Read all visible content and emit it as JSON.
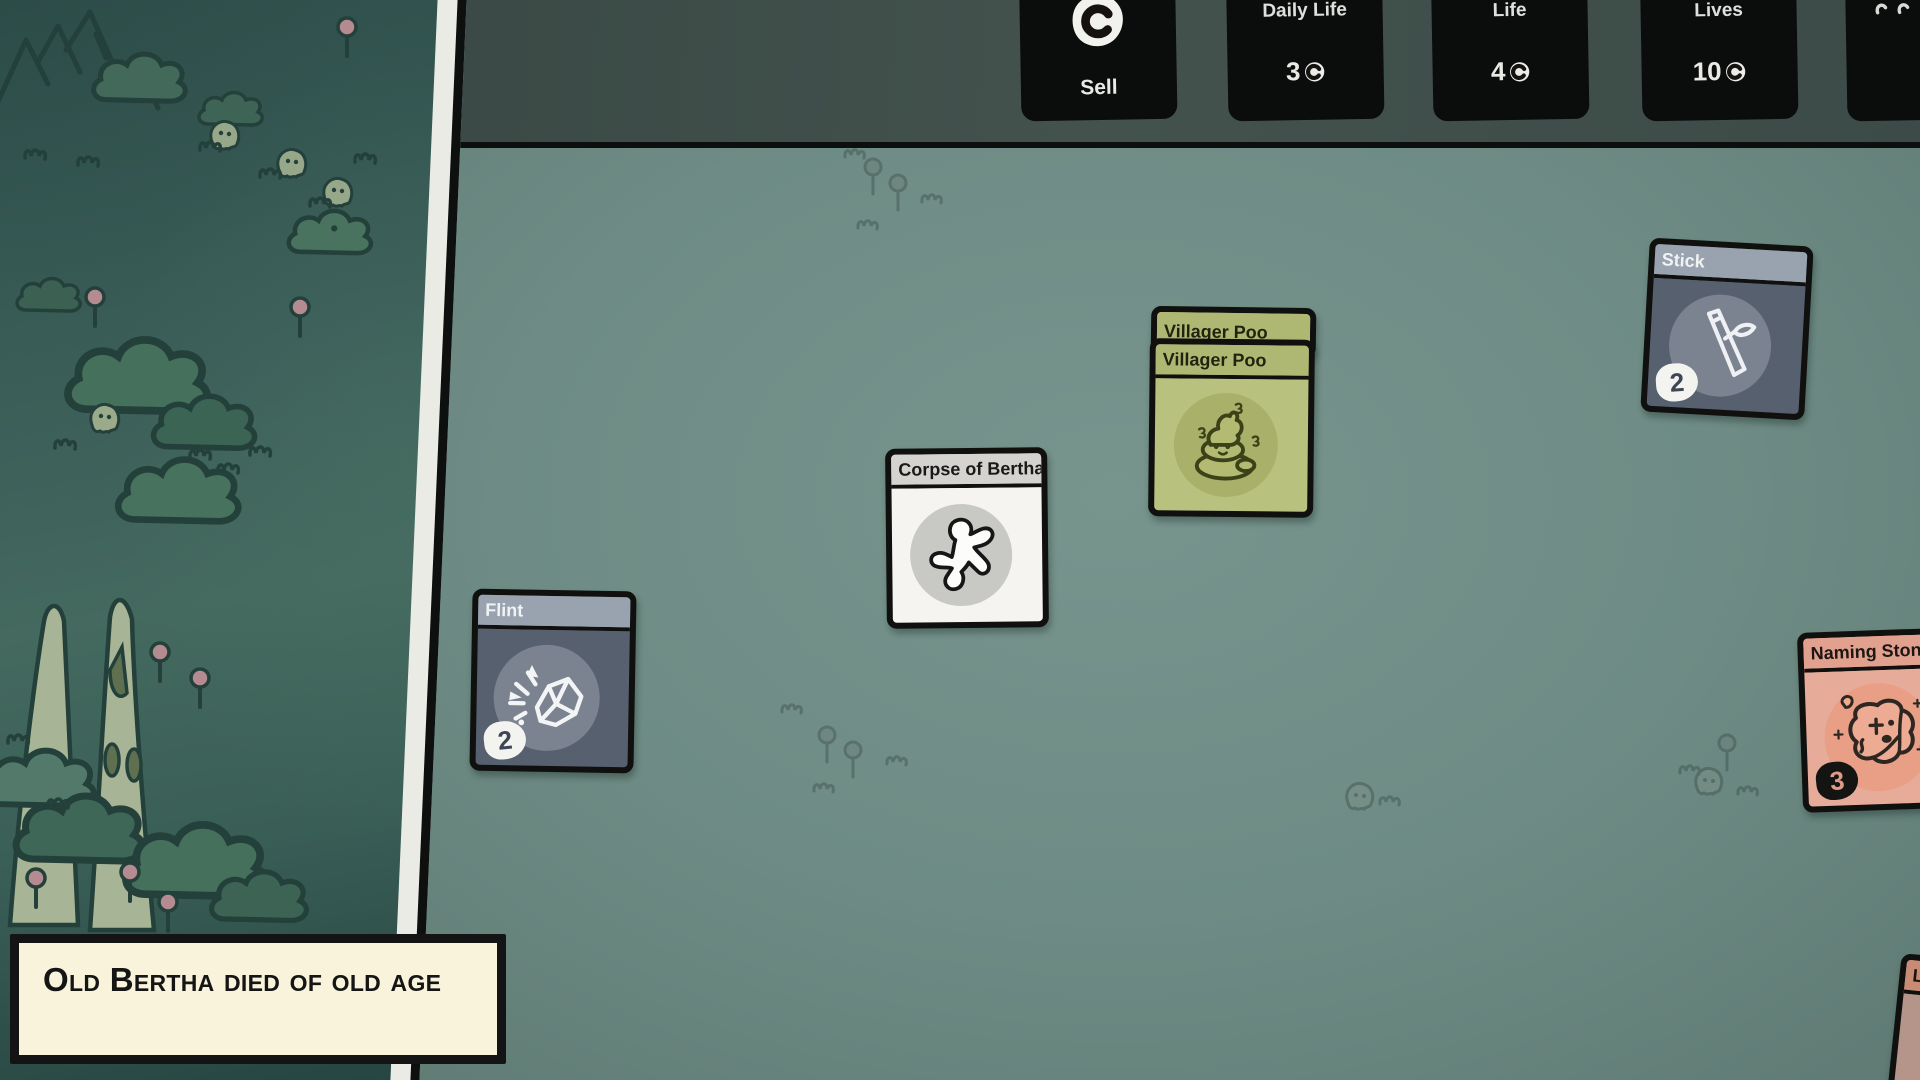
{
  "top_bar": {
    "sell_pack": {
      "label": "Sell",
      "icon": "coin-icon"
    },
    "packs": [
      {
        "name": "Daily Life",
        "price": "3",
        "currency_icon": "coin-icon"
      },
      {
        "name": "Life",
        "price": "4",
        "currency_icon": "coin-icon"
      },
      {
        "name": "Lives",
        "price": "10",
        "currency_icon": "coin-icon"
      }
    ]
  },
  "cards": {
    "flint": {
      "title": "Flint",
      "count": "2",
      "icon": "flint-rock-icon",
      "body_color": "#57606f",
      "title_bar_color": "#99a2af"
    },
    "corpse": {
      "title": "Corpse of Bertha",
      "icon": "body-outline-icon",
      "body_color": "#f5f4f1",
      "title_bar_color": "#d4d3d0"
    },
    "villager_poo_back": {
      "title": "Villager Poo"
    },
    "villager_poo": {
      "title": "Villager Poo",
      "icon": "poo-icon",
      "body_color": "#b9c17e",
      "title_bar_color": "#afb873"
    },
    "stick": {
      "title": "Stick",
      "count": "2",
      "icon": "stick-icon",
      "body_color": "#57606f",
      "title_bar_color": "#99a2af"
    },
    "naming_stone": {
      "title": "Naming Stone",
      "count": "3",
      "icon": "carved-stone-icon",
      "body_color": "#e7ab99",
      "title_bar_color": "#e2a18f"
    },
    "partial_bottom_right": {
      "title": "Lu"
    }
  },
  "notification": {
    "message": "Old Bertha died of old age"
  },
  "colors": {
    "board": "#71908a",
    "map": "#3a5d57",
    "top_band": "#3d4c48",
    "pack_bg": "#0b0c0c",
    "notification_bg": "#f8f3da",
    "ink": "#10100f",
    "badge_text": "#3e4554"
  }
}
